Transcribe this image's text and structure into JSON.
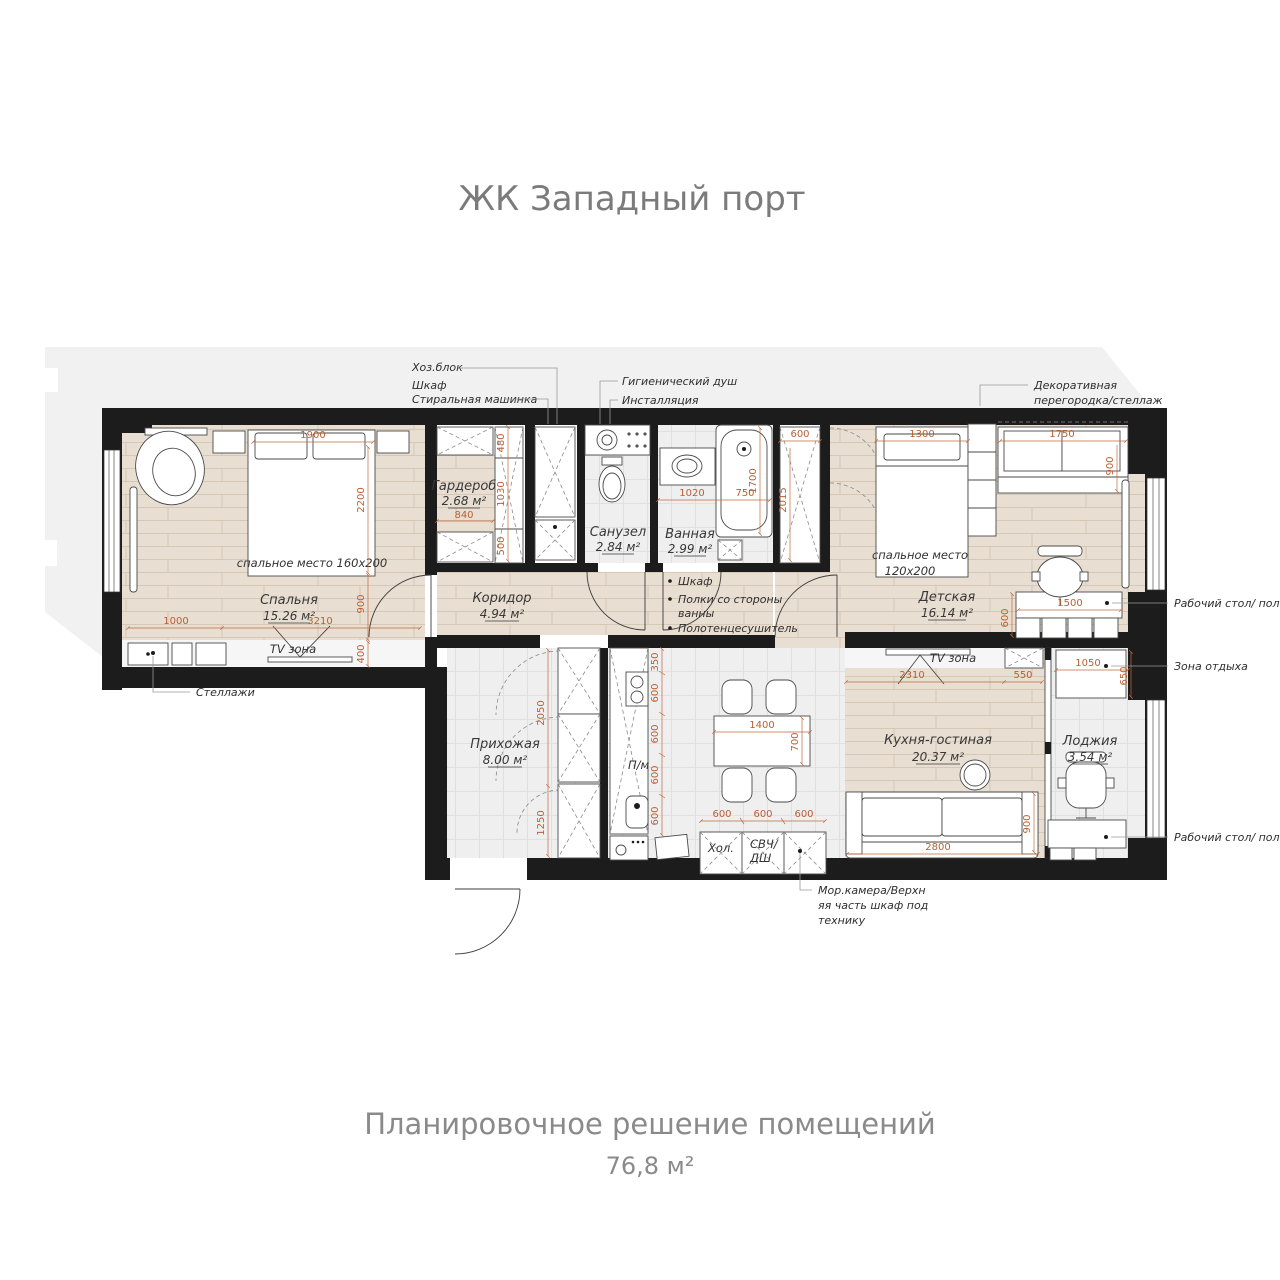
{
  "title": "ЖК Западный порт",
  "caption": {
    "line1": "Планировочное решение помещений",
    "line2": "76,8 м²"
  },
  "rooms": [
    {
      "name": "Спальня",
      "area": "15.26 м²"
    },
    {
      "name": "Гардероб",
      "area": "2.68 м²"
    },
    {
      "name": "Санузел",
      "area": "2.84 м²"
    },
    {
      "name": "Ванная",
      "area": "2.99 м²"
    },
    {
      "name": "Коридор",
      "area": "4.94 м²"
    },
    {
      "name": "Детская",
      "area": "16.14 м²"
    },
    {
      "name": "Прихожая",
      "area": "8.00 м²"
    },
    {
      "name": "Кухня-гостиная",
      "area": "20.37 м²"
    },
    {
      "name": "Лоджия",
      "area": "3.54 м²"
    }
  ],
  "furniture_labels": {
    "bed_master": "спальное место 160x200",
    "bed_child_1": "спальное место",
    "bed_child_2": "120x200",
    "tv_zone": "TV зона",
    "dishwasher": "П/м",
    "fridge": "Хол.",
    "microwave": "СВЧ/",
    "oven_drawer": "ДШ"
  },
  "annotations": {
    "utility": "Хоз.блок",
    "closet_top": "Шкаф",
    "washing_machine": "Стиральная машинка",
    "hygienic_shower": "Гигиенический душ",
    "installation": "Инсталляция",
    "decor_partition_1": "Декоративная",
    "decor_partition_2": "перегородка/стеллаж",
    "desk_shelves": "Рабочий стол/ полки",
    "rest_zone": "Зона отдыха",
    "shelving": "Стеллажи",
    "freezer_1": "Мор.камера/Верхн",
    "freezer_2": "яя часть шкаф под",
    "freezer_3": "технику",
    "corridor_closet": "Шкаф",
    "bath_shelves_1": "Полки со стороны",
    "bath_shelves_2": "ванны",
    "towel_rail": "Полотенцесушитель"
  },
  "dims": {
    "bedroom": [
      "1900",
      "2200",
      "900",
      "1000",
      "3210",
      "400"
    ],
    "wardrobe": [
      "480",
      "1030",
      "500",
      "840"
    ],
    "bathroom": [
      "1020",
      "750",
      "1700"
    ],
    "closet": [
      "600",
      "2015"
    ],
    "children": [
      "1300",
      "1750",
      "900",
      "1500",
      "600"
    ],
    "kitchen": [
      "2310",
      "550",
      "2800",
      "900"
    ],
    "dining": [
      "1400",
      "700",
      "600",
      "600",
      "600"
    ],
    "hallway": [
      "2050",
      "1250"
    ],
    "kitchen_row": [
      "350",
      "600",
      "600",
      "600",
      "600"
    ],
    "loggia": [
      "1050",
      "650"
    ]
  }
}
